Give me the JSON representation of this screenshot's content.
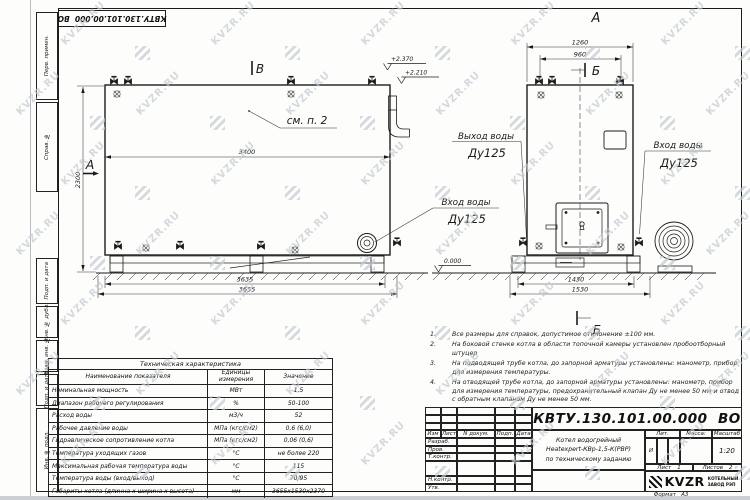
{
  "watermark": {
    "text": "KVZR.RU"
  },
  "stamp_top": "КВТУ.130.101.00.000  ВО",
  "margin_labels": [
    "Перв. примен.",
    "Справ. №",
    "Подп. и дата",
    "Инв. № дубл.",
    "Взам. инв. №",
    "Подп. и дата",
    "Инв. № подл."
  ],
  "side_view": {
    "section_b_top": "В",
    "section_a_left": "А",
    "callout_see": "см. п. 2",
    "dim_length": "3400",
    "dim_height": "2300",
    "dim_base": "3635",
    "dim_total": "3655",
    "elev_high": "+2.370",
    "elev_mid": "+2.210",
    "inlet_line1": "Вход воды",
    "inlet_line2": "Ду125"
  },
  "front_view": {
    "view_label": "А",
    "section_label_top": "Б",
    "section_label_bottom": "Б",
    "dim_top_outer": "1260",
    "dim_top_inner": "960",
    "dim_bottom_inner": "1430",
    "dim_bottom_outer": "1530",
    "elev_zero": "0.000",
    "outlet_line1": "Выход воды",
    "outlet_line2": "Ду125",
    "inlet_line1": "Вход воды",
    "inlet_line2": "Ду125"
  },
  "notes": {
    "items": [
      {
        "num": "1.",
        "text": "Все размеры для справок, допустимое отклонение ±100 мм."
      },
      {
        "num": "2.",
        "text": "На боковой стенке котла в области топочной камеры установлен пробоотборный штуцер"
      },
      {
        "num": "3.",
        "text": "На  подводящей трубе котла, до запорной арматуры установлены:  манометр, прибор для измерения температуры."
      },
      {
        "num": "4.",
        "text": "На отводящей трубе котла, до запорной арматуры установлены: манометр, прибор для измерения температуры, предохранительный клапан Ду не менее 50 мм и отвод с обратным клапаном Ду не менее 50 мм."
      }
    ]
  },
  "tech_table": {
    "title": "Техническая характеристика",
    "col_name": "Наименование показателя",
    "col_units": "Единицы измерения",
    "col_value": "Значение",
    "rows": [
      {
        "name": "Номинальная мощность",
        "units": "МВт",
        "value": "1,5"
      },
      {
        "name": "Диапазон рабочего регулирования",
        "units": "%",
        "value": "50-100"
      },
      {
        "name": "Расход воды",
        "units": "м3/ч",
        "value": "52"
      },
      {
        "name": "Рабочее давление воды",
        "units": "МПа (кгс/см2)",
        "value": "0,6 (6,0)"
      },
      {
        "name": "Гидравлическое сопротивление котла",
        "units": "МПа (кгс/см2)",
        "value": "0,06 (0,6)"
      },
      {
        "name": "Температура уходящих газов",
        "units": "°С",
        "value": "не более 220"
      },
      {
        "name": "Максимальная рабочая температура воды",
        "units": "°С",
        "value": "115"
      },
      {
        "name": "Температура воды (вход/выход)",
        "units": "°С",
        "value": "70/95"
      },
      {
        "name": "Габариты котла (длинна х ширина х высота)",
        "units": "мм",
        "value": "3655х1530х2370"
      }
    ]
  },
  "title_block": {
    "doc_number": "КВТУ.130.101.00.000  ВО",
    "col_izm": "Изм",
    "col_list": "Лист",
    "col_doc": "N докум.",
    "col_sign": "Подп.",
    "col_date": "Дата",
    "row_razrab": "Разраб.",
    "row_prov": "Пров.",
    "row_tkontr": "Т.контр.",
    "row_nkontr": "Н.контр.",
    "row_utv": "Утв.",
    "title_line1": "Котел водогрейный",
    "title_line2": "Heatexpert-КВр-1,5-К(РВР)",
    "title_line3": "по техническому заданию",
    "lit_label": "Лит.",
    "lit_value": "И",
    "mass_label": "Масса:",
    "scale_label": "Масштаб",
    "scale_value": "1:20",
    "sheet_label": "Лист",
    "sheet_num": "1",
    "sheets_label": "Листов",
    "sheets_num": "2",
    "logo_text": "KVZR",
    "company_line1": "КОТЕЛЬНЫЙ",
    "company_line2": "ЗАВОД РЭП",
    "format_note": "Формат   А3"
  }
}
